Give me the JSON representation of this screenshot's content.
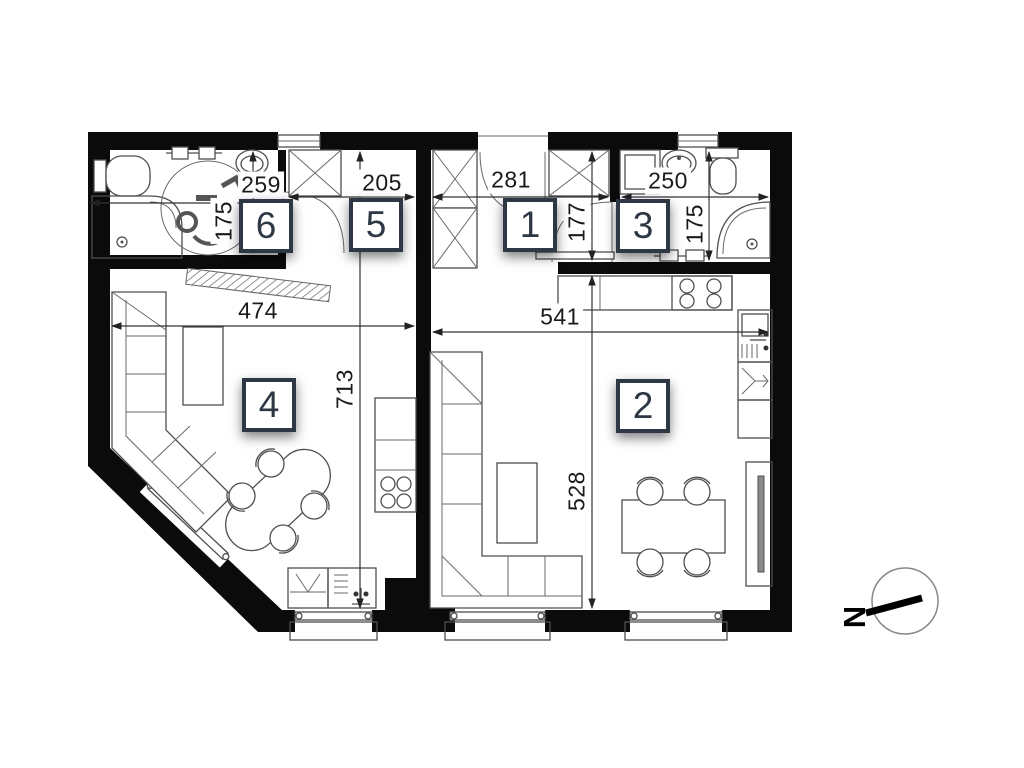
{
  "rooms": [
    {
      "number": "1"
    },
    {
      "number": "2"
    },
    {
      "number": "3"
    },
    {
      "number": "4"
    },
    {
      "number": "5"
    },
    {
      "number": "6"
    }
  ],
  "dimensions": {
    "bath6_width": "259",
    "bath6_height": "175",
    "corridor5_width": "205",
    "hall1_width": "281",
    "hall1_height": "177",
    "bath3_width": "250",
    "bath3_height": "175",
    "room4_width": "474",
    "room4_depth": "713",
    "room2_width": "541",
    "room2_depth": "528"
  },
  "compass": {
    "north_label": "N"
  },
  "colors": {
    "wall": "#0b0b0b",
    "badge_border": "#2e3744",
    "line": "#4f4f4f"
  }
}
